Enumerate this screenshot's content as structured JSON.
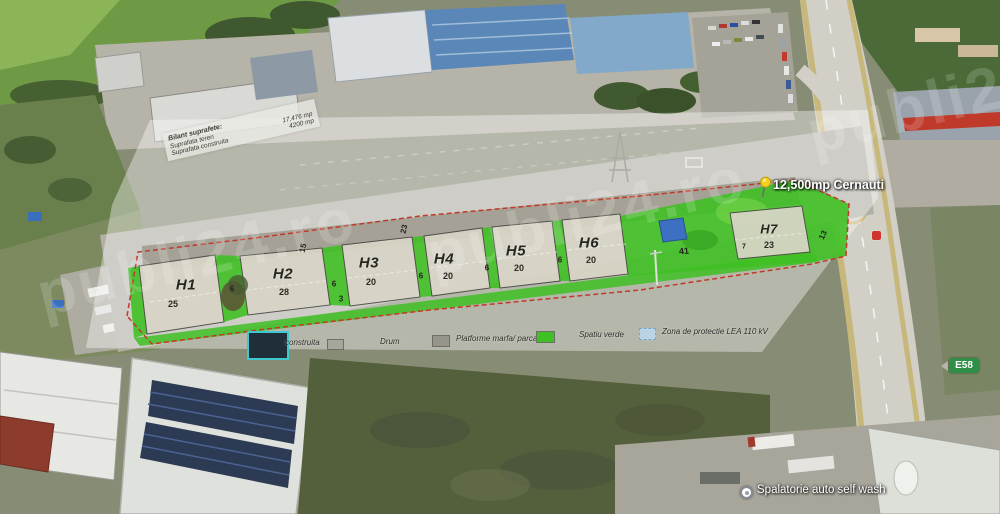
{
  "watermark": {
    "text": "publi24.ro"
  },
  "pin": {
    "label": "12,500mp Cernauti"
  },
  "info_box": {
    "title": "Bilant suprafete:",
    "rows": [
      {
        "label": "Suprafata teren",
        "value": "17,476 mp"
      },
      {
        "label": "Suprafata construita",
        "value": "4200 mp"
      }
    ]
  },
  "parcels": [
    {
      "name": "H1",
      "value": "25"
    },
    {
      "name": "H2",
      "value": "28"
    },
    {
      "name": "H3",
      "value": "20"
    },
    {
      "name": "H4",
      "value": "20"
    },
    {
      "name": "H5",
      "value": "20"
    },
    {
      "name": "H6",
      "value": "20"
    },
    {
      "name": "H7",
      "value": "23"
    }
  ],
  "dims": [
    "6",
    "6",
    "6",
    "6",
    "6",
    "3",
    "15",
    "23",
    "41",
    "7",
    "13"
  ],
  "legend": {
    "items": [
      {
        "label": "construita",
        "color": "#22313c"
      },
      {
        "label": "Drum",
        "color": "#a8a59a"
      },
      {
        "label": "Platforme marfa/ parcari",
        "color": "#97948a"
      },
      {
        "label": "Spatiu verde",
        "color": "#3fc024"
      },
      {
        "label": "Zona de protectie LEA 110 kV",
        "color": "#bad4e6"
      }
    ]
  },
  "map_labels": {
    "road_shield": "E58",
    "poi": "Spalatorie auto self wash"
  }
}
